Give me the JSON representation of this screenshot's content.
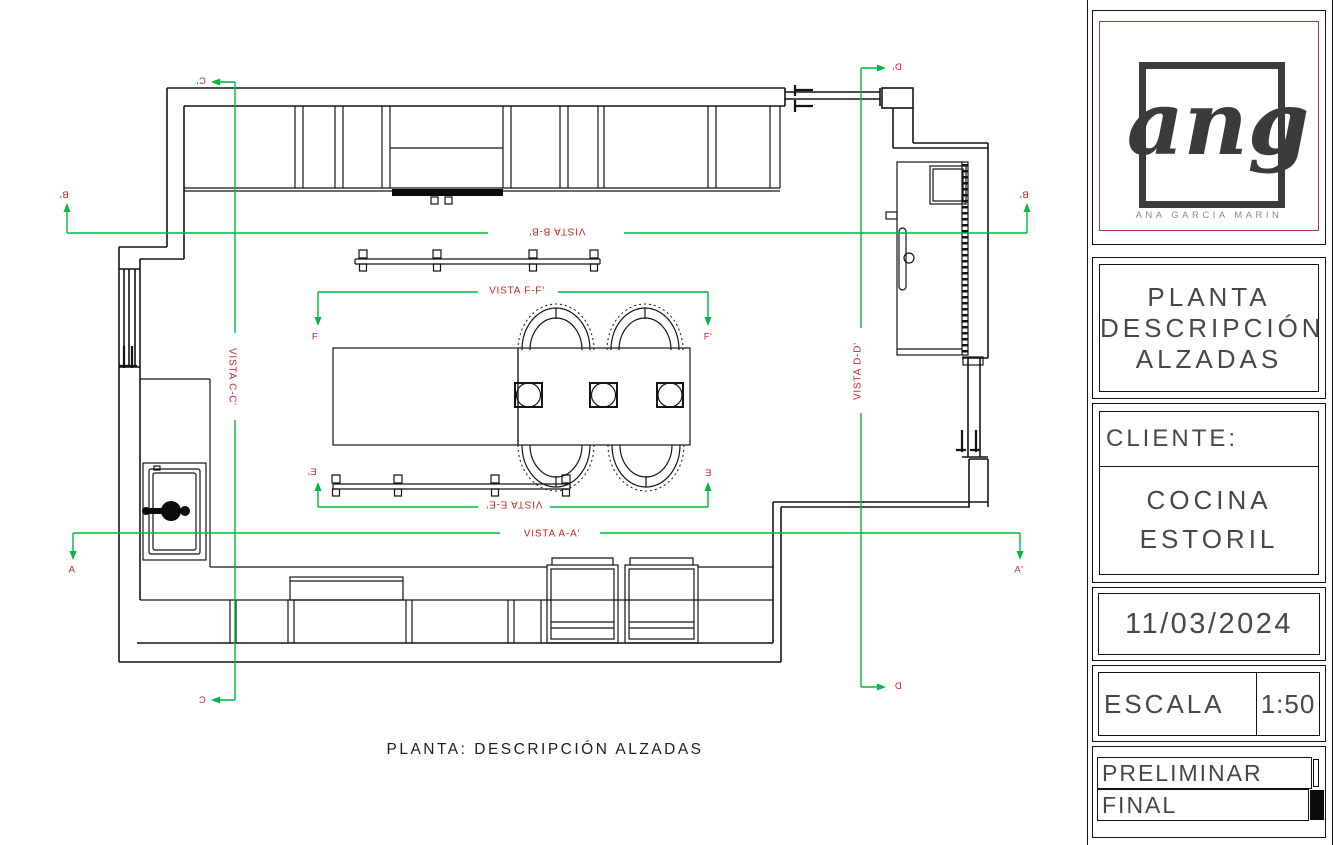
{
  "drawing": {
    "caption": "PLANTA:  DESCRIPCIÓN  ALZADAS",
    "views": {
      "aa": "VISTA A-A'",
      "bb": "VISTA B-B'",
      "cc": "VISTA C-C'",
      "dd": "VISTA D-D'",
      "ee": "VISTA E-E'",
      "ff": "VISTA F-F'"
    },
    "markers": {
      "a_left": "A",
      "a_right": "A'",
      "b_left": "B'",
      "b_right": "B'",
      "c_top": "C'",
      "c_bottom": "C",
      "d_top": "D'",
      "d_bottom": "D",
      "e_left": "E'",
      "e_right": "E",
      "f_left": "F",
      "f_right": "F'"
    },
    "colors": {
      "section_line": "#00b93e",
      "label": "#c9252b",
      "linework": "#141414"
    }
  },
  "title_block": {
    "logo": {
      "text": "ang",
      "subtext": "ANA GARCIA MARIN",
      "border_color": "#b03a3a"
    },
    "sheet_title": {
      "line1": "PLANTA",
      "line2": "DESCRIPCIÓN",
      "line3": "ALZADAS"
    },
    "client": {
      "label": "CLIENTE:",
      "line1": "COCINA",
      "line2": "ESTORIL"
    },
    "date": "11/03/2024",
    "scale": {
      "label": "ESCALA",
      "value": "1:50"
    },
    "status": {
      "option1": "PRELIMINAR",
      "option2": "FINAL"
    }
  }
}
